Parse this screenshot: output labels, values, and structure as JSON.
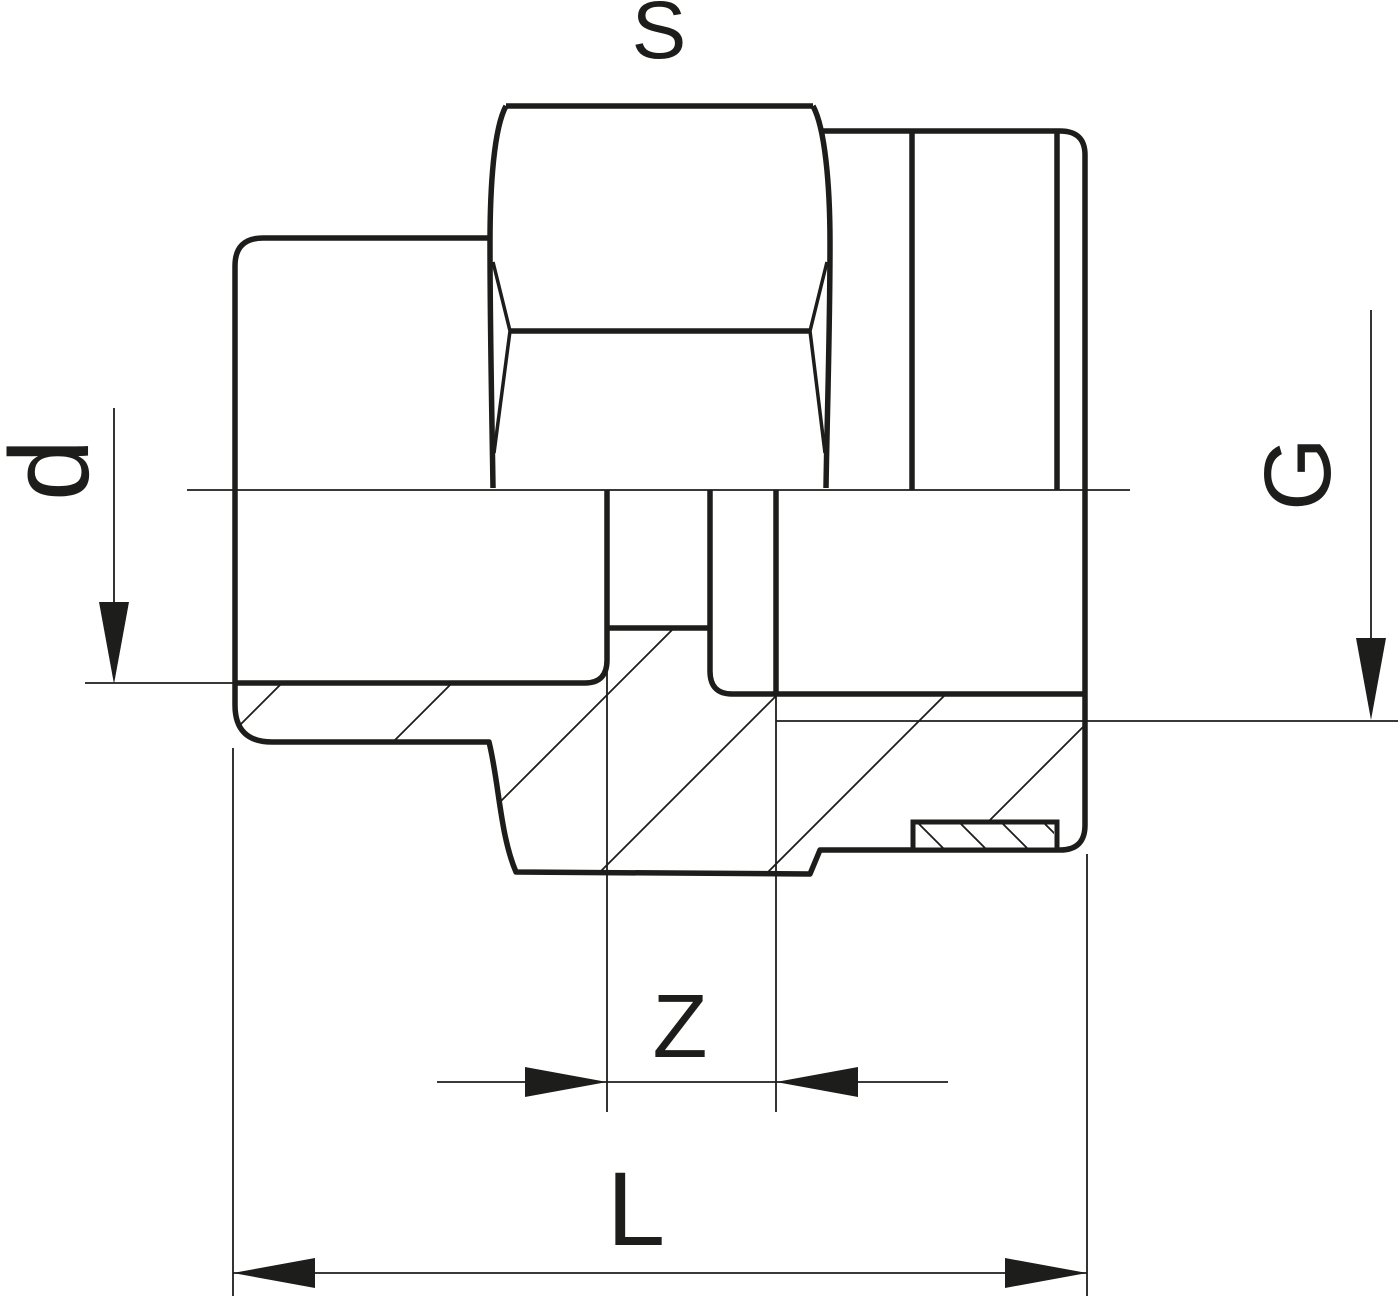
{
  "drawing": {
    "title": "Union adaptor with female thread - section drawing",
    "labels": {
      "width_across_flats": "S",
      "socket_diameter": "d",
      "thread_size": "G",
      "z_dimension": "Z",
      "overall_length": "L"
    },
    "colors": {
      "line": "#1d1d1b",
      "background": "#ffffff"
    }
  }
}
